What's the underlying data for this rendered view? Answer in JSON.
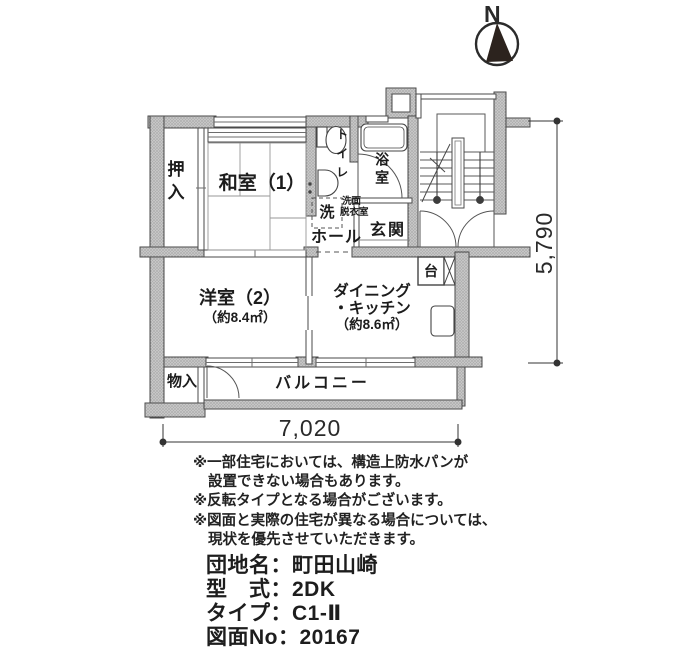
{
  "compass": {
    "label": "N"
  },
  "plan": {
    "labels": {
      "oshiire": "押入",
      "washitsu": "和室（1）",
      "toilet": "トイレ",
      "senmen1": "洗面",
      "senmen2": "脱衣室",
      "laundry": "洗",
      "bath": "浴室",
      "hall": "ホール",
      "genkan": "玄関",
      "counter": "台",
      "dk1": "ダイニング",
      "dk2": "・キッチン",
      "dk_area": "（約8.6㎡）",
      "western": "洋室（2）",
      "western_area": "（約8.4㎡）",
      "storage": "物入",
      "balcony": "バルコニー"
    },
    "dimensions": {
      "width_mm": "7,020",
      "height_mm": "5,790"
    }
  },
  "notes": {
    "lines": [
      "※一部住宅においては、構造上防水パンが",
      "設置できない場合もあります。",
      "※反転タイプとなる場合がございます。",
      "※図面と実際の住宅が異なる場合については、",
      "現状を優先させていただきます。"
    ]
  },
  "info": {
    "lines": [
      "団地名：町田山崎",
      "型　式：2DK",
      "タイプ：C1-Ⅱ",
      "図面No：20167"
    ]
  }
}
